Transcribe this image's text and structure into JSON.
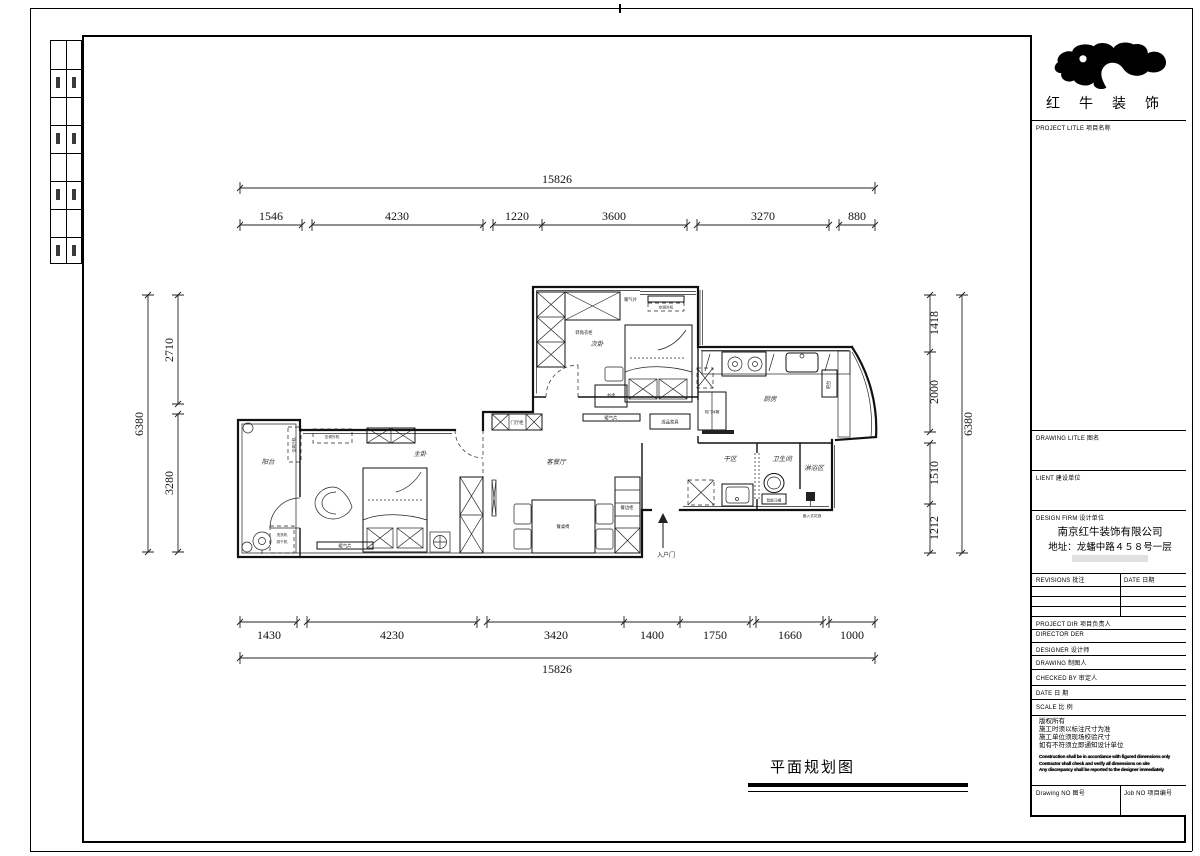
{
  "page": {
    "footer_title": "平面规划图"
  },
  "title_block": {
    "logo_text": "红牛装饰",
    "project_title": "PROJECT LITLE  项目名称",
    "drawing_title": "DRAWING LITLE  图名",
    "client": "LIENT  建设单位",
    "design_firm": "DESIGN FIRM  设计单位",
    "company_name": "南京红牛装饰有限公司",
    "company_addr": "地址：龙蟠中路４５８号一层",
    "revisions": "REVISIONS  批注",
    "rev_date": "DATE  日期",
    "project_dir": "PROJECT DIR   项目负责人",
    "director": "DIRECTOR DER",
    "designer": "DESIGNER      设计师",
    "drawing_by": "DRAWING      制图人",
    "checked_by": "CHECKED BY   审定人",
    "date": "DATE          日   期",
    "scale": "SCALE         比   例",
    "notes_cn": [
      "版权所有",
      "施工时须以标注尺寸为准",
      "施工单位须现场校验尺寸",
      "如有不符须立即通知设计单位"
    ],
    "notes_en": [
      "Construction shall be in accordance with figured dimensions only",
      "Contractor shall check and verify all dimensions on site",
      "Any discrepancy shall be reported to the designer immediately"
    ],
    "drawing_no": "Drawing NO  图号",
    "job_no": "Job NO  项目编号"
  },
  "dims": {
    "top_total": "15826",
    "top": [
      "1546",
      "4230",
      "1220",
      "3600",
      "3270",
      "880"
    ],
    "bottom": [
      "1430",
      "4230",
      "3420",
      "1400",
      "1750",
      "1660",
      "1000"
    ],
    "bottom_total": "15826",
    "left": [
      "2710",
      "3280"
    ],
    "left_total": "6380",
    "right": [
      "1418",
      "2000",
      "1510",
      "1212"
    ],
    "right_total": "6380"
  },
  "rooms": {
    "balcony": "阳台",
    "master": "主卧",
    "second": "次卧",
    "living": "客餐厅",
    "kitchen": "厨房",
    "dry": "干区",
    "bath": "卫生间",
    "shower": "淋浴区"
  },
  "furniture": {
    "corner_wardrobe": "转角衣柜",
    "desk": "书桌",
    "radiator": "暖气片",
    "ac_unit": "空调外机",
    "finished": "成品家具",
    "washer": "洗衣机",
    "dryer": "烘干机",
    "dining_set": "餐桌椅",
    "sideboard": "餐边柜",
    "hall_cabinet": "门厅柜",
    "fridge": "双门冰箱",
    "bar": "吧台",
    "smart_toilet": "智能马桶",
    "shower_head": "嵌入式花洒",
    "entrance": "入户门"
  }
}
